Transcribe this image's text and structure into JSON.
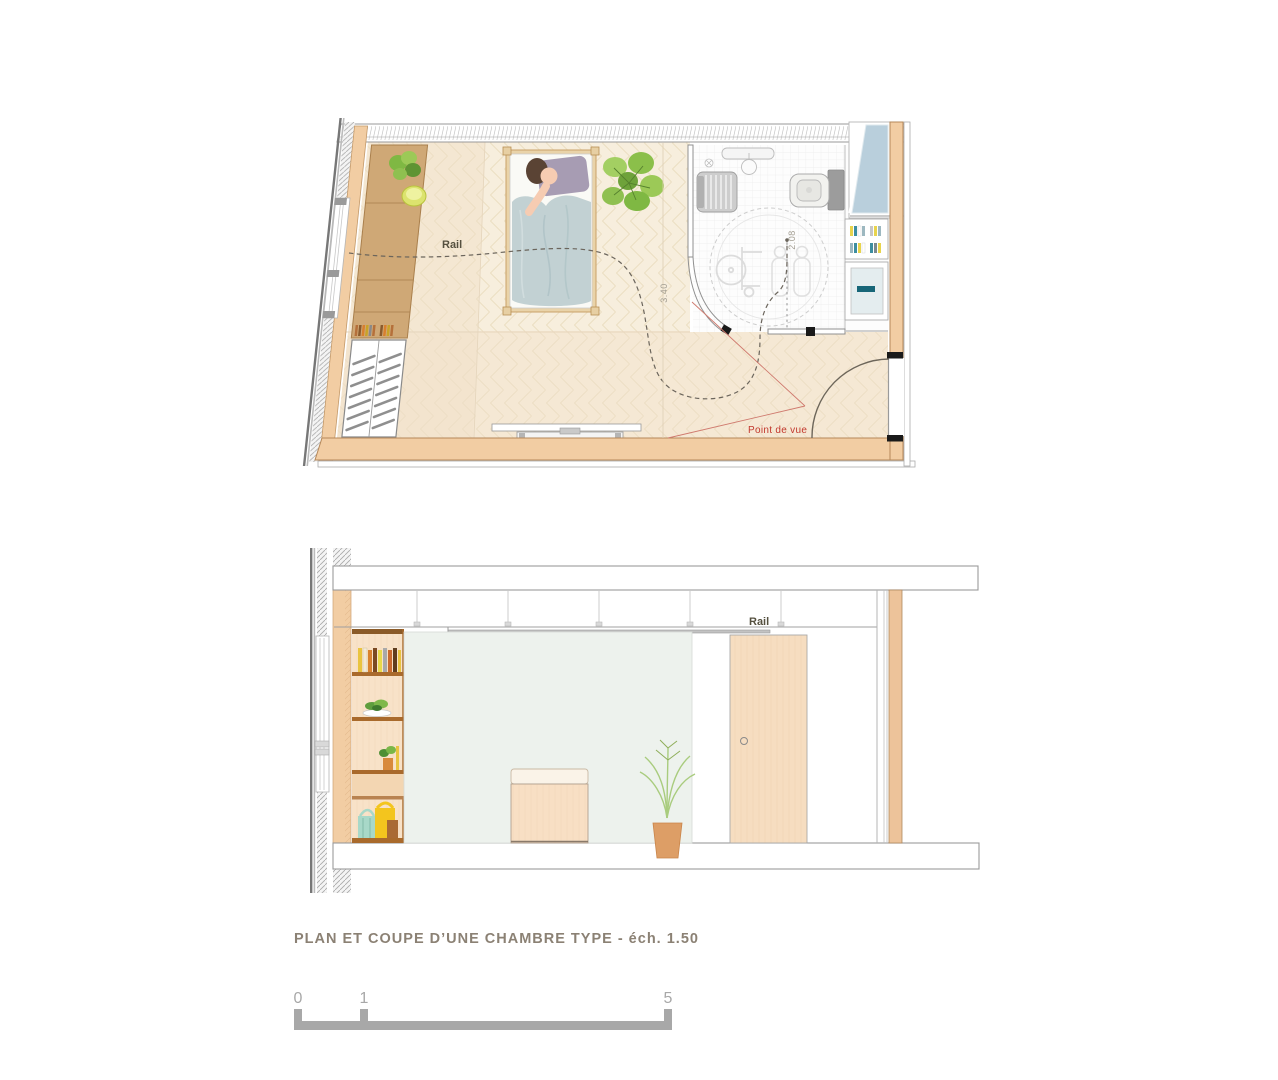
{
  "document": {
    "background": "#ffffff",
    "type": "architectural drawing"
  },
  "plan": {
    "labels": {
      "rail": "Rail",
      "dim_depth": "3.40",
      "dim_bath": "2.08",
      "point_of_view": "Point de vue"
    }
  },
  "section": {
    "labels": {
      "rail": "Rail"
    }
  },
  "caption": {
    "title": "PLAN ET COUPE D’UNE CHAMBRE TYPE - éch. 1.50"
  },
  "scale_bar": {
    "tick_0": "0",
    "tick_1": "1",
    "tick_5": "5"
  },
  "colors": {
    "wall_fill": "#f2cda3",
    "wall_edge": "#b5885a",
    "floor": "#f7eedd",
    "floor_pattern_line": "#eadcbf",
    "bath_floor": "#fdfdfd",
    "tile_line": "#ececec",
    "glass_blue": "#b9cfdc",
    "section_wall_green": "#edf2ed",
    "wood_light": "#f6ddc0",
    "desk_tan": "#cfa876",
    "shelf_board_brown": "#a96a2c",
    "rail_line": "#6b655c",
    "dim_text": "#a39e92",
    "accent_red": "#c2392e",
    "caption_text": "#8b8174",
    "scale_bar_gray": "#a8a8a8",
    "teal_accent": "#176678"
  }
}
